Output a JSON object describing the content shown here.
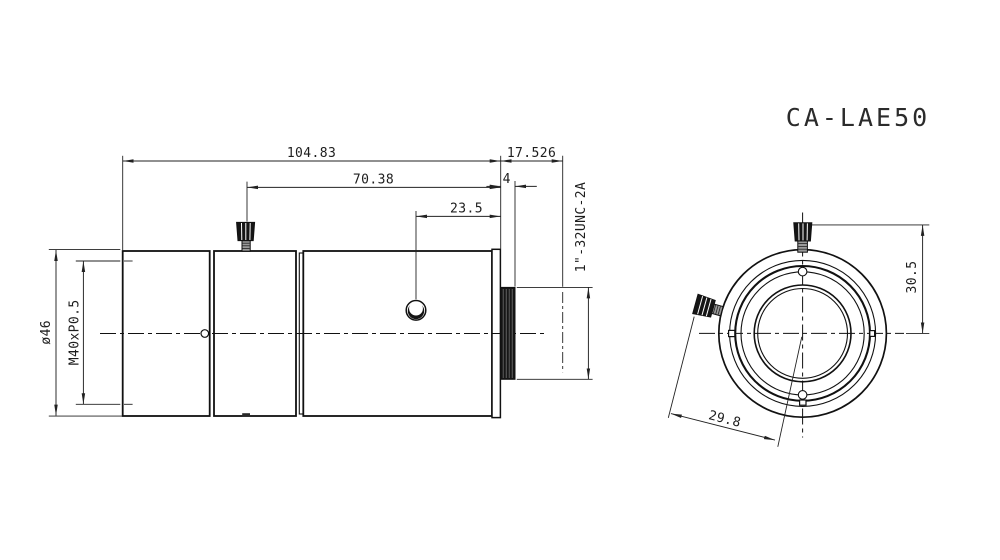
{
  "title": "CA-LAE50",
  "side_view": {
    "dim_overall_length": "104.83",
    "dim_flange_focal": "17.526",
    "dim_screw_to_flange": "70.38",
    "dim_thread_length": "4",
    "dim_hole_to_flange": "23.5",
    "dim_outer_diameter": "ø46",
    "dim_rear_thread": "M40xP0.5",
    "dim_mount_thread": "1\"-32UNC-2A"
  },
  "front_view": {
    "dim_screw_top_to_center": "30.5",
    "dim_screw_offset": "29.8"
  }
}
